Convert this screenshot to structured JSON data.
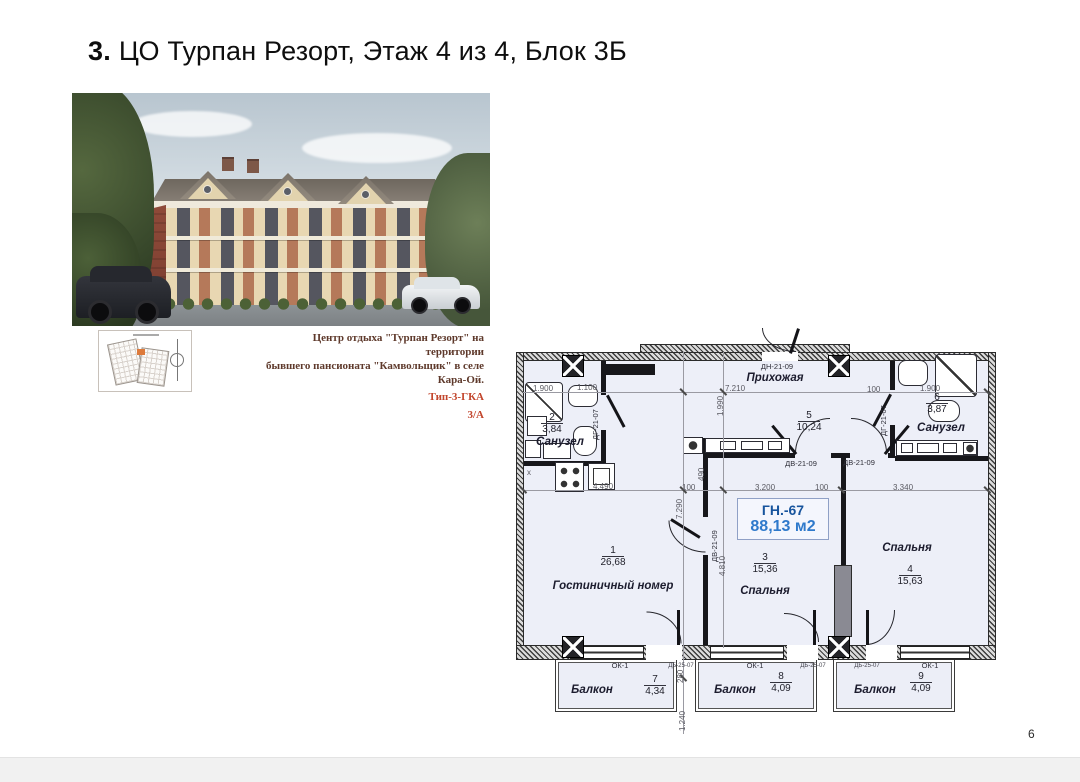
{
  "page": {
    "number": "6"
  },
  "title": {
    "number": "3.",
    "text": "ЦО Турпан Резорт, Этаж 4 из 4, Блок 3Б"
  },
  "caption": {
    "line1": "Центр отдыха \"Турпан Резорт\" на территории",
    "line2": "бывшего пансионата \"Камвольщик\" в селе Кара-Ой.",
    "type": "Тип-3-ГКА",
    "block": "3/А"
  },
  "plan": {
    "unit_code": "ГН.-67",
    "unit_area": "88,13 м2",
    "kitchen_mark": "x",
    "rooms": {
      "r1": {
        "num": "1",
        "area": "26,68",
        "name": "Гостиничный номер"
      },
      "r2": {
        "num": "2",
        "area": "3,84",
        "name": "Санузел"
      },
      "r3": {
        "num": "3",
        "area": "15,36",
        "name": "Спальня"
      },
      "r4": {
        "num": "4",
        "area": "15,63",
        "name": "Спальня"
      },
      "r5": {
        "num": "5",
        "area": "10,24",
        "name": "Прихожая"
      },
      "r6": {
        "num": "6",
        "area": "3,87",
        "name": "Санузел"
      },
      "r7": {
        "num": "7",
        "area": "4,34",
        "name": "Балкон"
      },
      "r8": {
        "num": "8",
        "area": "4,09",
        "name": "Балкон"
      },
      "r9": {
        "num": "9",
        "area": "4,09",
        "name": "Балкон"
      }
    },
    "doors": {
      "entry": "ДН-21-09",
      "bath": "ДГ-21-07",
      "interior": "ДВ-21-09",
      "balcony": "ДБ-25-07",
      "window": "ОК-1"
    },
    "dims": {
      "d1900": "1.900",
      "d1100": "1.100",
      "d7210": "7.210",
      "d100": "100",
      "d1990": "1.990",
      "d490": "490",
      "d4490": "4.490",
      "d3200": "3.200",
      "d3340": "3.340",
      "d7290": "7.290",
      "d4810": "4.810",
      "d280": "280",
      "d1240": "1.240"
    }
  }
}
